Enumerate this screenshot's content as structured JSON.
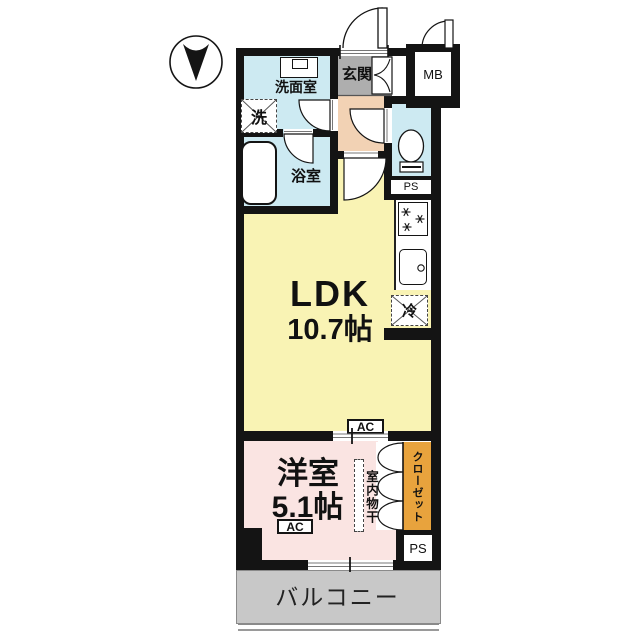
{
  "compass": {
    "direction_note": "north-arrow-pointing-down"
  },
  "rooms": {
    "entrance": {
      "label": "玄関"
    },
    "washroom": {
      "label": "洗面室"
    },
    "bathroom": {
      "label": "浴室"
    },
    "ldk": {
      "label": "LDK",
      "size": "10.7帖"
    },
    "western": {
      "label": "洋室",
      "size": "5.1帖"
    },
    "closet": {
      "label": "クローゼット"
    },
    "balcony": {
      "label": "バルコニー"
    }
  },
  "fixtures": {
    "washer": {
      "label": "洗"
    },
    "fridge": {
      "label": "冷"
    },
    "indoor_drying": {
      "label": "室内物干"
    },
    "meter_box": {
      "label": "MB"
    },
    "pipe_space_upper": {
      "label": "PS"
    },
    "pipe_space_lower": {
      "label": "PS"
    },
    "ac_ldk": {
      "label": "AC"
    },
    "ac_western": {
      "label": "AC"
    }
  },
  "colors": {
    "wall": "#141414",
    "wet_room": "#cdeaf2",
    "entrance_gray": "#aeaeae",
    "hall_peach": "#f2d2b4",
    "ldk_yellow": "#f9f3b4",
    "western_pink": "#fae4e2",
    "closet_orange": "#e8a33d",
    "balcony_gray": "#c8c8c8"
  }
}
